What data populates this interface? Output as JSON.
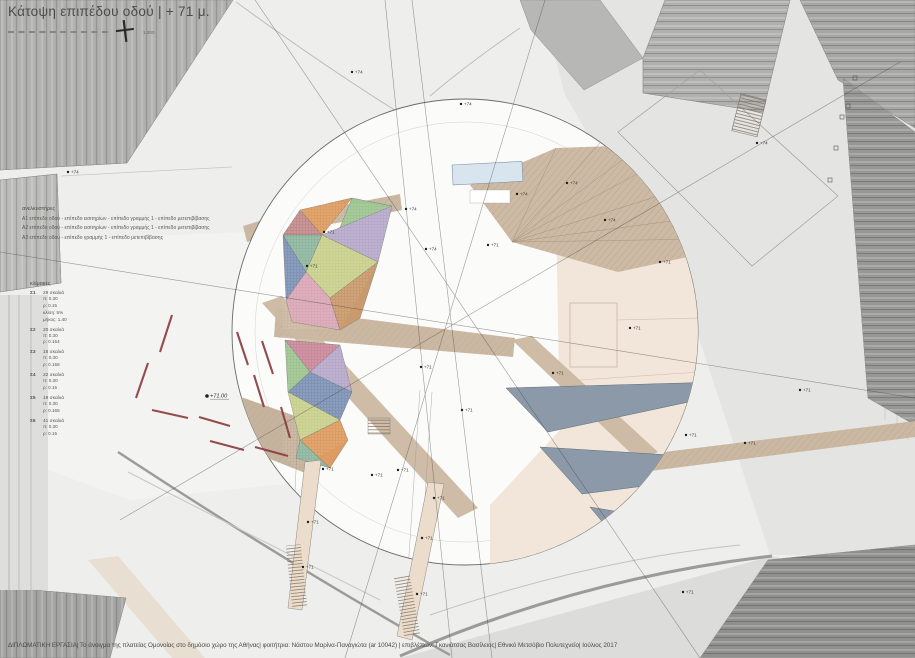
{
  "sheet": {
    "title": "Κάτοψη επιπέδου οδού | + 71 μ.",
    "scale_note": "1:200",
    "caption": "ΔΙΠΛΩΜΑΤΙΚΗ ΕΡΓΑΣΙΑ| Το άνοιγμα της πλατείας Ομονοίας στο δημόσιο χώρο της Αθήνας| φοιτήτρια: Νάστου Μαρίνα-Παναγιώτα (ar 10042) | επιβλέπων: Γκανιάτσας Βασίλειος| Εθνικό Μετσόβιο Πολυτεχνείο| Ιούλιος 2017"
  },
  "legends": {
    "elevators": {
      "heading": "ανελκυστήρες",
      "items": [
        "Α1  επίπεδο οδού - επίπεδο εισιτηρίων - επίπεδο γραμμής 1 - επίπεδο μετεπιβίβασης",
        "Α2  επίπεδο οδού - επίπεδο εισιτηρίων - επίπεδο γραμμής 1 - επίπεδο μετεπιβίβασης",
        "Α3  επίπεδο οδού - επίπεδο γραμμής 1 - επίπεδο μετεπιβίβασης"
      ]
    },
    "stairs": {
      "heading": "κλίμακες",
      "items": [
        {
          "id": "Σ1",
          "steps": "29 σκαλιά",
          "details": [
            "π: 0.30",
            "ρ: 0.15",
            "κλίση: 5%",
            "μήκος: 1.40"
          ]
        },
        {
          "id": "Σ2",
          "steps": "20 σκαλιά",
          "details": [
            "π: 0.30",
            "ρ: 0.154"
          ]
        },
        {
          "id": "Σ3",
          "steps": "16 σκαλιά",
          "details": [
            "π: 0.30",
            "ρ: 0.158"
          ]
        },
        {
          "id": "Σ4",
          "steps": "22 σκαλιά",
          "details": [
            "π: 0.30",
            "ρ: 0.15"
          ]
        },
        {
          "id": "Σ5",
          "steps": "19 σκαλιά",
          "details": [
            "π: 0.30",
            "ρ: 0.165"
          ]
        },
        {
          "id": "Σ6",
          "steps": "41 σκαλιά",
          "details": [
            "π: 0.30",
            "ρ: 0.15"
          ]
        }
      ]
    }
  },
  "plan": {
    "level_markers": [
      {
        "x": 207,
        "y": 396,
        "label": "+71.00",
        "big": true
      },
      {
        "x": 324,
        "y": 232,
        "label": "+71"
      },
      {
        "x": 307,
        "y": 266,
        "label": "+71"
      },
      {
        "x": 406,
        "y": 209,
        "label": "+74"
      },
      {
        "x": 426,
        "y": 249,
        "label": "+74"
      },
      {
        "x": 488,
        "y": 245,
        "label": "+71"
      },
      {
        "x": 517,
        "y": 194,
        "label": "+74"
      },
      {
        "x": 567,
        "y": 183,
        "label": "+74"
      },
      {
        "x": 605,
        "y": 220,
        "label": "+74"
      },
      {
        "x": 660,
        "y": 262,
        "label": "+71"
      },
      {
        "x": 630,
        "y": 328,
        "label": "+71"
      },
      {
        "x": 553,
        "y": 373,
        "label": "+71"
      },
      {
        "x": 421,
        "y": 367,
        "label": "+71"
      },
      {
        "x": 462,
        "y": 410,
        "label": "+71"
      },
      {
        "x": 398,
        "y": 470,
        "label": "+71"
      },
      {
        "x": 323,
        "y": 469,
        "label": "+71"
      },
      {
        "x": 372,
        "y": 475,
        "label": "+71"
      },
      {
        "x": 308,
        "y": 522,
        "label": "+71"
      },
      {
        "x": 434,
        "y": 498,
        "label": "+71"
      },
      {
        "x": 422,
        "y": 538,
        "label": "+71"
      },
      {
        "x": 303,
        "y": 567,
        "label": "+71"
      },
      {
        "x": 417,
        "y": 594,
        "label": "+71"
      },
      {
        "x": 683,
        "y": 592,
        "label": "+71"
      },
      {
        "x": 686,
        "y": 435,
        "label": "+71"
      },
      {
        "x": 745,
        "y": 443,
        "label": "+71"
      },
      {
        "x": 800,
        "y": 390,
        "label": "+71"
      },
      {
        "x": 757,
        "y": 143,
        "label": "+74"
      },
      {
        "x": 352,
        "y": 72,
        "label": "+74"
      },
      {
        "x": 461,
        "y": 104,
        "label": "+74"
      },
      {
        "x": 68,
        "y": 172,
        "label": "+74"
      }
    ]
  },
  "colors": {
    "paper": "#eeefed",
    "building_grey": "#b1b1af",
    "walkway_tan": "#cbb8a2",
    "plaza_peach": "#f2e5d9",
    "canopy_slate": "#8b99a8",
    "bench_red": "#8a3a3c",
    "skylight_blue": "#d8e5ee",
    "mosaic_palette": [
      "#dd9d62",
      "#9ec492",
      "#c28b8b",
      "#b7a9ca",
      "#8fb7a0",
      "#c9d08e",
      "#d9a7b5",
      "#7f93b5"
    ]
  }
}
